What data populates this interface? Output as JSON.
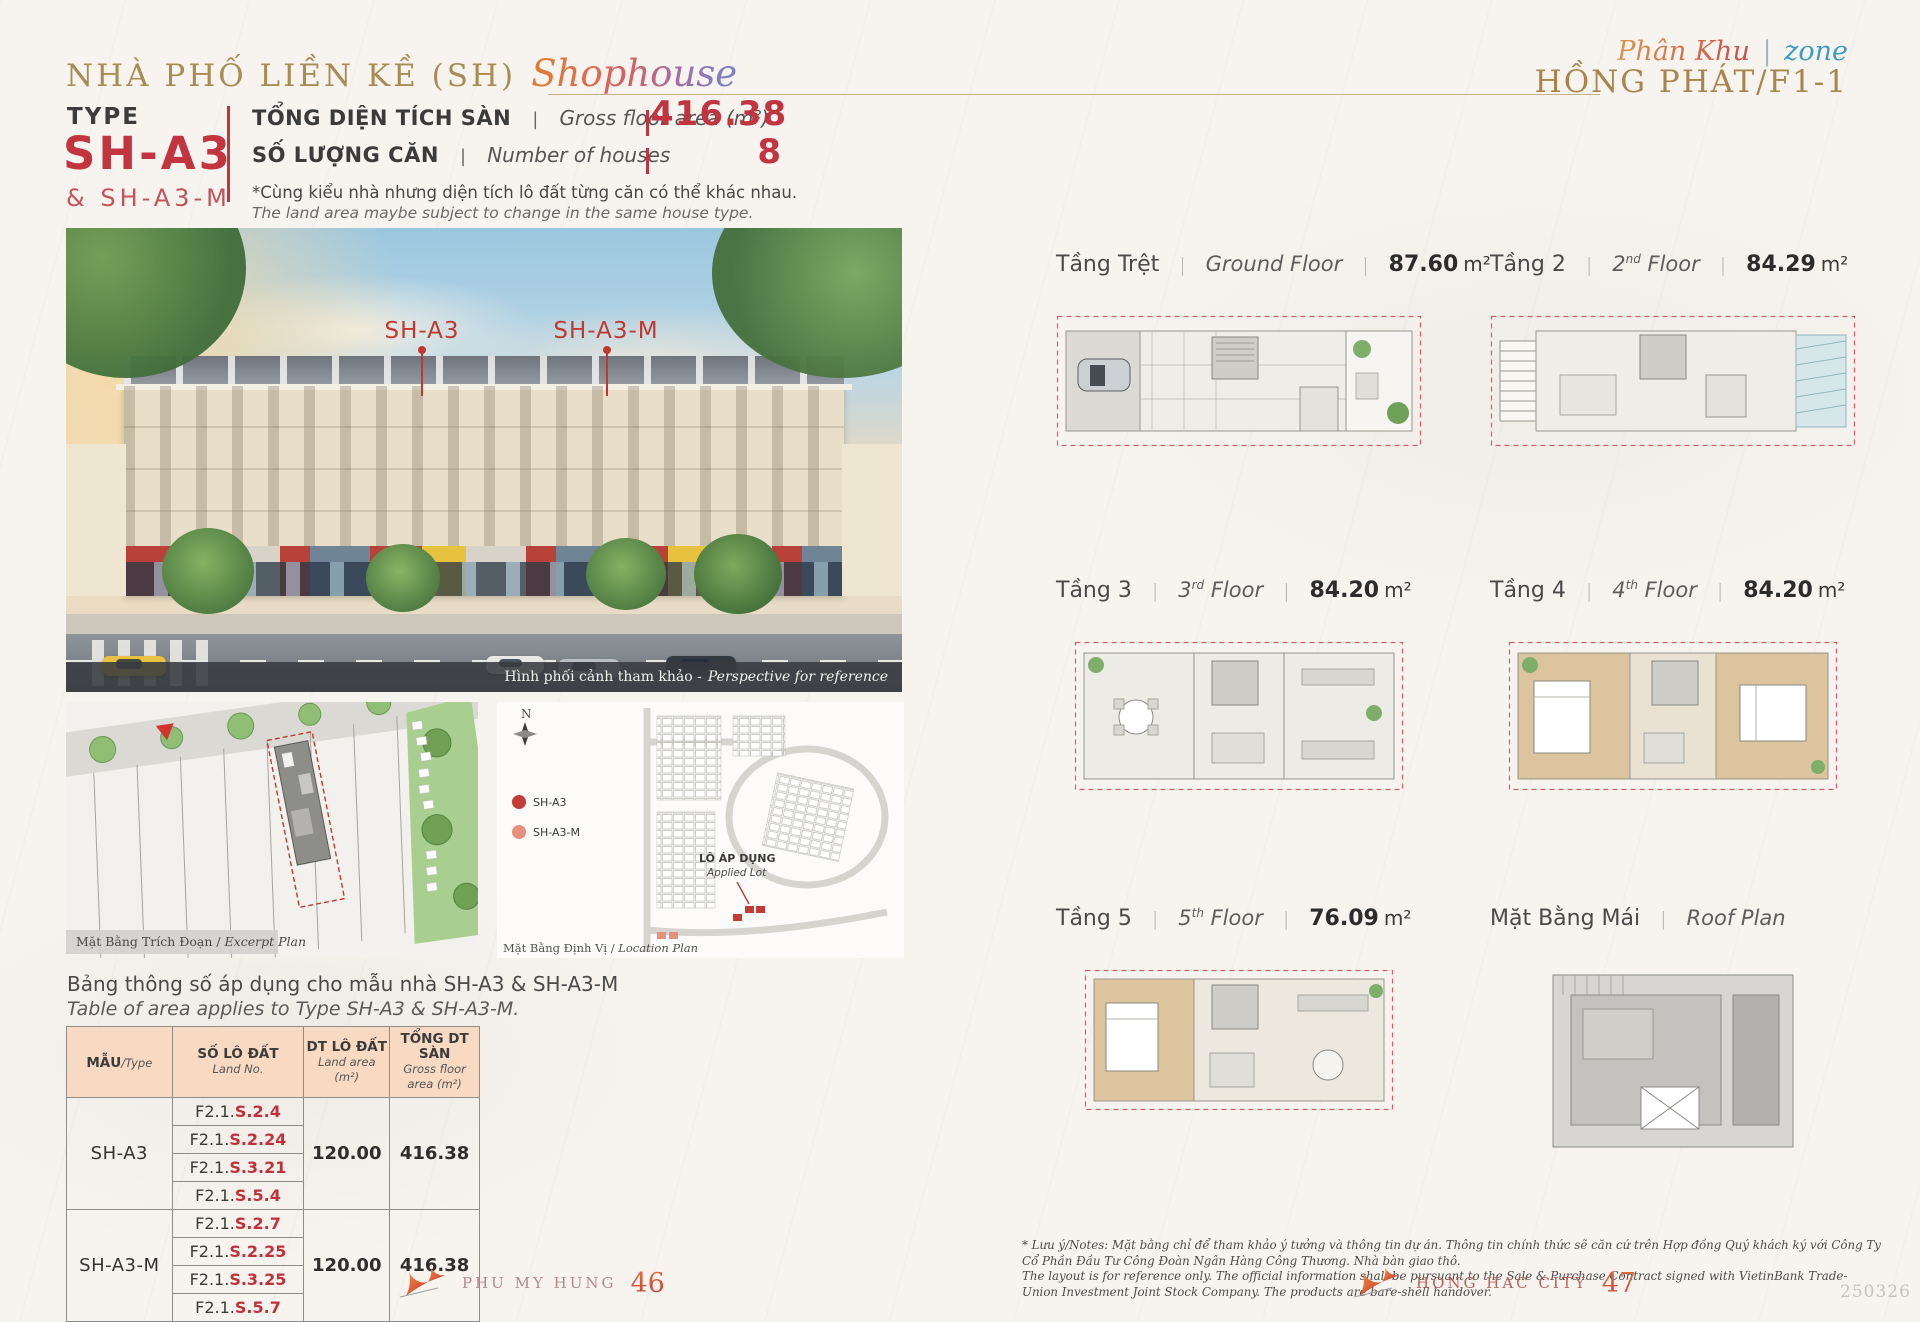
{
  "ui": {
    "sep": "|",
    "slash": "/",
    "compass": "N"
  },
  "header": {
    "title_vi": "NHÀ PHỐ LIỀN KỀ (SH)",
    "title_script": "Shophouse",
    "zone_script_vi": "Phân Khu",
    "zone_script_sep": "|",
    "zone_script_en": "zone",
    "zone_name": "HỒNG PHÁT/F1-1"
  },
  "type_block": {
    "label": "TYPE",
    "code": "SH-A3",
    "code_alt": "& SH-A3-M",
    "stat1_vi": "TỔNG DIỆN TÍCH SÀN",
    "stat1_en": "Gross floor area (m²)",
    "stat1_value": "416.38",
    "stat2_vi": "SỐ LƯỢNG CĂN",
    "stat2_en": "Number of houses",
    "stat2_value": "8",
    "note_vi": "*Cùng kiểu nhà nhưng diện tích lô đất từng căn có thể khác nhau.",
    "note_en": "The land area maybe subject to change in the same house type."
  },
  "perspective": {
    "label_a": "SH-A3",
    "label_b": "SH-A3-M",
    "caption_vi": "Hình phối cảnh tham khảo -",
    "caption_en": "Perspective for reference"
  },
  "excerpt_plan": {
    "caption_vi": "Mặt Bằng Trích Đoạn / ",
    "caption_en": "Excerpt Plan"
  },
  "location_plan": {
    "caption_vi": "Mặt Bằng Định Vị / ",
    "caption_en": "Location Plan",
    "legend": [
      {
        "label": "SH-A3",
        "color": "#c43a34"
      },
      {
        "label": "SH-A3-M",
        "color": "#e78f7d"
      }
    ],
    "applied_lot_vi": "LÔ ÁP DỤNG",
    "applied_lot_en": "Applied Lot"
  },
  "area_table": {
    "title_vi": "Bảng thông số áp dụng cho mẫu nhà SH-A3 & SH-A3-M",
    "title_en": "Table of area applies to Type SH-A3 & SH-A3-M.",
    "headers": [
      {
        "vi": "MẪU",
        "en": "Type"
      },
      {
        "vi": "SỐ LÔ ĐẤT",
        "en": "Land No."
      },
      {
        "vi": "DT LÔ ĐẤT",
        "en": "Land area (m²)"
      },
      {
        "vi": "TỔNG DT SÀN",
        "en": "Gross floor area (m²)"
      }
    ],
    "rows": [
      {
        "type": "SH-A3",
        "lots": [
          {
            "prefix": "F2.1.",
            "code": "S.2.4"
          },
          {
            "prefix": "F2.1.",
            "code": "S.2.24"
          },
          {
            "prefix": "F2.1.",
            "code": "S.3.21"
          },
          {
            "prefix": "F2.1.",
            "code": "S.5.4"
          }
        ],
        "land_area": "120.00",
        "gross_area": "416.38"
      },
      {
        "type": "SH-A3-M",
        "lots": [
          {
            "prefix": "F2.1.",
            "code": "S.2.7"
          },
          {
            "prefix": "F2.1.",
            "code": "S.2.25"
          },
          {
            "prefix": "F2.1.",
            "code": "S.3.25"
          },
          {
            "prefix": "F2.1.",
            "code": "S.5.7"
          }
        ],
        "land_area": "120.00",
        "gross_area": "416.38"
      }
    ]
  },
  "floors": [
    {
      "vi": "Tầng Trệt",
      "en_a": "Ground Floor",
      "en_sup": "",
      "en_b": "",
      "sep2": "|",
      "area": "87.60",
      "unit": "m²"
    },
    {
      "vi": "Tầng 2",
      "en_a": "2",
      "en_sup": "nd",
      "en_b": " Floor",
      "sep2": "|",
      "area": "84.29",
      "unit": "m²"
    },
    {
      "vi": "Tầng 3",
      "en_a": "3",
      "en_sup": "rd",
      "en_b": " Floor",
      "sep2": "|",
      "area": "84.20",
      "unit": "m²"
    },
    {
      "vi": "Tầng 4",
      "en_a": "4",
      "en_sup": "th",
      "en_b": " Floor",
      "sep2": "|",
      "area": "84.20",
      "unit": "m²"
    },
    {
      "vi": "Tầng 5",
      "en_a": "5",
      "en_sup": "th",
      "en_b": " Floor",
      "sep2": "|",
      "area": "76.09",
      "unit": "m²"
    },
    {
      "vi": "Mặt Bằng Mái",
      "en_a": "Roof Plan",
      "en_sup": "",
      "en_b": "",
      "sep2": "",
      "area": "",
      "unit": ""
    }
  ],
  "footer": {
    "left_brand": "PHU MY HUNG",
    "left_page": "46",
    "right_brand": "HONG HAC CITY",
    "right_page": "47",
    "doc_code": "250326",
    "note_line1": "* Lưu ý/Notes: Mặt bằng chỉ để tham khảo ý tưởng và thông tin dự án. Thông tin chính thức sẽ căn cứ trên Hợp đồng Quý khách ký với Công Ty Cổ Phần Đầu Tư Công Đoàn Ngân Hàng Công Thương. Nhà bàn giao thô.",
    "note_line2": "The layout is for reference only. The official information shall be pursuant to the Sale & Purchase Contract signed with VietinBank Trade-Union Investment Joint Stock Company. The products are bare-shell handover."
  },
  "colors": {
    "accent_red": "#c23540",
    "gold": "#a98c54",
    "peach": "#f8d9c2"
  }
}
